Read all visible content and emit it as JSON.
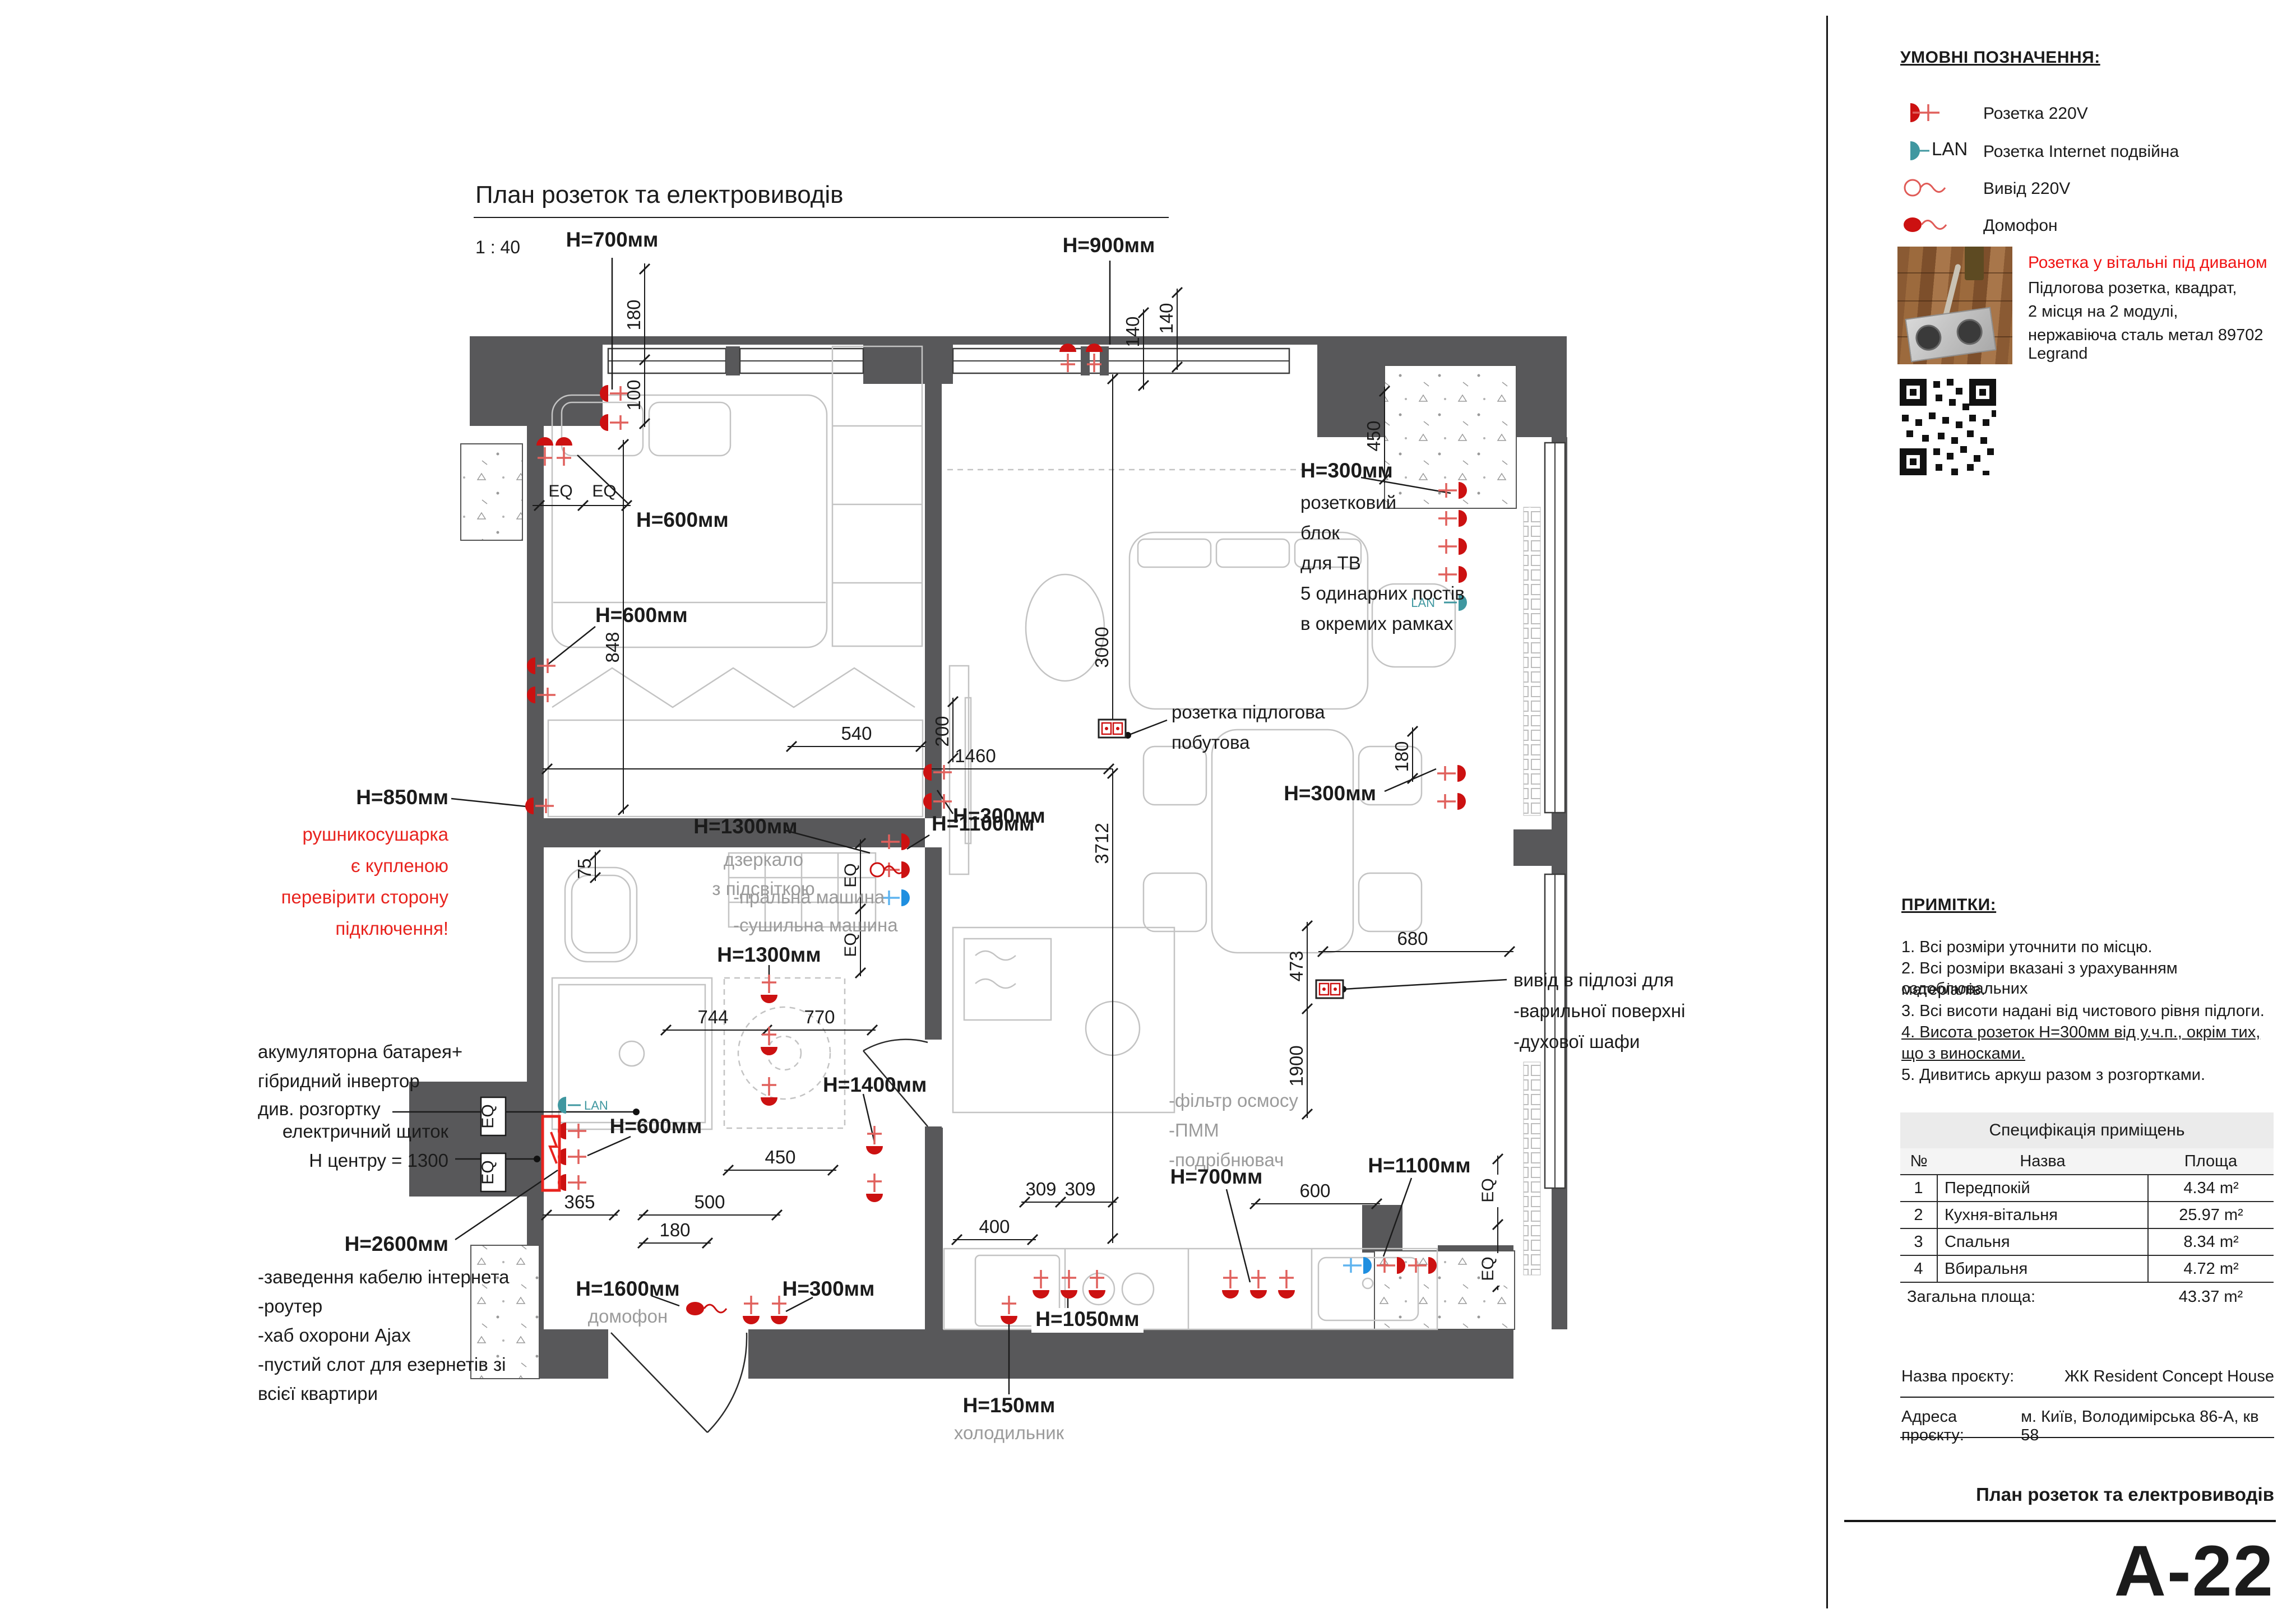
{
  "sheet": {
    "plan_title": "План розеток та електровиводів",
    "scale": "1 : 40",
    "code": "A-22",
    "footer_title": "План розеток та електровиводів"
  },
  "legend": {
    "title": "УМОВНІ ПОЗНАЧЕННЯ:",
    "items": [
      {
        "icon": "outlet-220v-icon",
        "label": "Розетка 220V"
      },
      {
        "icon": "outlet-internet-icon",
        "label": "Розетка Internet подвійна"
      },
      {
        "icon": "output-220v-icon",
        "label": "Вивід 220V"
      },
      {
        "icon": "intercom-icon",
        "label": "Домофон"
      }
    ],
    "callout": {
      "title": "Розетка у вітальні під диваном",
      "lines": [
        "Підлогова розетка, квадрат,",
        "2 місця на 2 модулі,",
        "нержавіюча сталь метал 89702 Legrand"
      ]
    }
  },
  "notes": {
    "title": "ПРИМІТКИ:",
    "items": [
      "1. Всі розміри уточнити по місцю.",
      "2. Всі розміри вказані з урахуванням оздоблювальних",
      "матеріалів.",
      "3. Всі висоти надані від чистового рівня підлоги.",
      "4. Висота розеток Н=300мм від у.ч.п., окрім тих,",
      "що з виносками.",
      "5. Дивитись аркуш разом з розгортками."
    ]
  },
  "spec_table": {
    "title": "Специфікація приміщень",
    "headers": {
      "num": "№",
      "name": "Назва",
      "area": "Площа"
    },
    "rows": [
      {
        "num": "1",
        "name": "Передпокій",
        "area": "4.34 m²"
      },
      {
        "num": "2",
        "name": "Кухня-вітальня",
        "area": "25.97 m²"
      },
      {
        "num": "3",
        "name": "Спальня",
        "area": "8.34 m²"
      },
      {
        "num": "4",
        "name": "Вбиральня",
        "area": "4.72 m²"
      }
    ],
    "total_label": "Загальна площа:",
    "total_value": "43.37 m²"
  },
  "title_block": {
    "project_label": "Назва проєкту:",
    "project_value": "ЖК Resident Concept House",
    "address_label": "Адреса проєкту:",
    "address_value": "м. Київ, Володимірська 86-А, кв 58"
  },
  "icons": {
    "lan_label": "LAN"
  },
  "colors": {
    "outlet_red": "#cc1111",
    "note_red": "#e8231e",
    "lan_teal": "#3f97a0",
    "outlet_blue": "#1f8fe0",
    "wall_gray": "#58585a"
  },
  "plan": {
    "labels": [
      {
        "t": "План розеток та електровиводів"
      },
      {
        "t": "1 : 40"
      },
      {
        "t": "H=700мм"
      },
      {
        "t": "180"
      },
      {
        "t": "100"
      },
      {
        "t": "EQ"
      },
      {
        "t": "EQ"
      },
      {
        "t": "H=600мм"
      },
      {
        "t": "H=900мм"
      },
      {
        "t": "140"
      },
      {
        "t": "140"
      },
      {
        "t": "H=300мм"
      },
      {
        "t": "розетковий"
      },
      {
        "t": "блок"
      },
      {
        "t": "для ТВ"
      },
      {
        "t": "5 одинарних постів"
      },
      {
        "t": "в окремих рамках"
      },
      {
        "t": "450"
      },
      {
        "t": "H=600мм"
      },
      {
        "t": "848"
      },
      {
        "t": "200"
      },
      {
        "t": "H=300мм"
      },
      {
        "t": "3000"
      },
      {
        "t": "540"
      },
      {
        "t": "1460"
      },
      {
        "t": "розетка підлогова"
      },
      {
        "t": "побутова"
      },
      {
        "t": "3712"
      },
      {
        "t": "H=850мм"
      },
      {
        "t": "рушникосушарка"
      },
      {
        "t": "є купленою"
      },
      {
        "t": "перевірити сторону"
      },
      {
        "t": "підключення!"
      },
      {
        "t": "75"
      },
      {
        "t": "H=1300мм"
      },
      {
        "t": "дзеркало"
      },
      {
        "t": "з підсвіткою"
      },
      {
        "t": "H=1100мм"
      },
      {
        "t": "EQ"
      },
      {
        "t": "EQ"
      },
      {
        "t": "H=300мм"
      },
      {
        "t": "180"
      },
      {
        "t": "-пральна машина"
      },
      {
        "t": "-сушильна машина"
      },
      {
        "t": "H=1300мм"
      },
      {
        "t": "744"
      },
      {
        "t": "770"
      },
      {
        "t": "680"
      },
      {
        "t": "473"
      },
      {
        "t": "1900"
      },
      {
        "t": "вивід в підлозі для"
      },
      {
        "t": "-варильної поверхні"
      },
      {
        "t": "-духової шафи"
      },
      {
        "t": "-фільтр осмосу"
      },
      {
        "t": "-ПММ"
      },
      {
        "t": "-подрібнювач"
      },
      {
        "t": "акумуляторна батарея+"
      },
      {
        "t": "гібридний інвертор"
      },
      {
        "t": "див. розгортку"
      },
      {
        "t": "електричний щиток"
      },
      {
        "t": "Н центру = 1300"
      },
      {
        "t": "H=2600мм"
      },
      {
        "t": "-заведення кабелю інтернета"
      },
      {
        "t": "-роутер"
      },
      {
        "t": "-хаб охорони Ajax"
      },
      {
        "t": "-пустий слот для езернетів зі"
      },
      {
        "t": "всієї квартири"
      },
      {
        "t": "H=1400мм"
      },
      {
        "t": "450"
      },
      {
        "t": "H=600мм"
      },
      {
        "t": "365"
      },
      {
        "t": "500"
      },
      {
        "t": "180"
      },
      {
        "t": "H=1600мм"
      },
      {
        "t": "домофон"
      },
      {
        "t": "H=300мм"
      },
      {
        "t": "309"
      },
      {
        "t": "309"
      },
      {
        "t": "400"
      },
      {
        "t": "H=1050мм"
      },
      {
        "t": "H=150мм"
      },
      {
        "t": "холодильник"
      },
      {
        "t": "H=700мм"
      },
      {
        "t": "600"
      },
      {
        "t": "H=1100мм"
      },
      {
        "t": "EQ"
      },
      {
        "t": "EQ"
      },
      {
        "t": "EQ"
      },
      {
        "t": "EQ"
      }
    ]
  }
}
